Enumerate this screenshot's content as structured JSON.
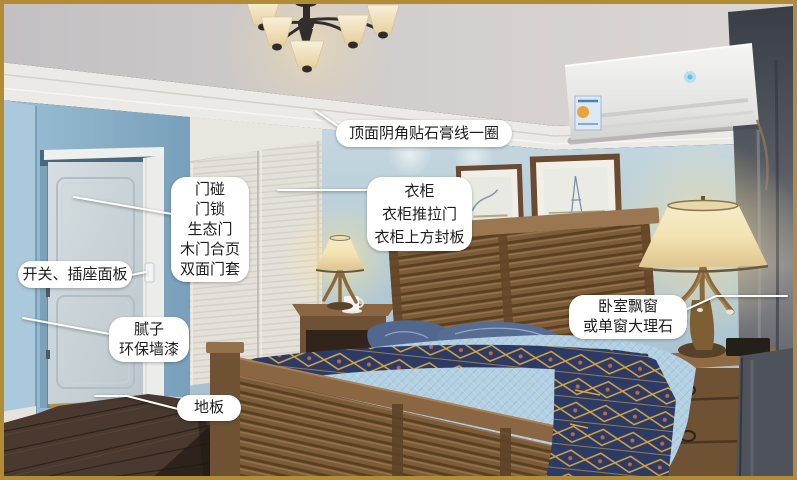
{
  "labels": {
    "ceiling": {
      "text": "顶面阴角贴石膏线一圈"
    },
    "door": {
      "lines": [
        "门碰",
        "门锁",
        "生态门",
        "木门合页",
        "双面门套"
      ]
    },
    "switch": {
      "text": "开关、插座面板"
    },
    "wall_paint": {
      "lines": [
        "腻子",
        "环保墙漆"
      ]
    },
    "floor": {
      "text": "地板"
    },
    "wardrobe": {
      "lines": [
        "衣柜",
        "衣柜推拉门",
        "衣柜上方封板"
      ]
    },
    "bay_window": {
      "lines": [
        "卧室飘窗",
        "或单窗大理石"
      ]
    }
  },
  "scene": {
    "objects": [
      "chandelier",
      "crown-molding",
      "air-conditioner",
      "wall-art",
      "wardrobe-sliding-doors",
      "eco-door",
      "light-switch",
      "bed",
      "headboard",
      "pillows",
      "throw-blanket",
      "footboard",
      "nightstands",
      "table-lamps",
      "curtain",
      "wood-floor"
    ],
    "colors": {
      "frame_gold": "#b28c34",
      "ceiling_gray": "#cfccce",
      "molding_white": "#eceae6",
      "wall_blue": "#85abc4",
      "back_wall_blue": "#b7cdd9",
      "wardrobe_white": "#e4e1db",
      "door_white": "#cbd4da",
      "headboard_wood": "#7c5b39",
      "nightstand_wood": "#6f5234",
      "floor_wood": "#4a392e",
      "bedspread_blue": "#b3d0e2",
      "pillow_blue": "#52678e",
      "throw_navy": "#2c3a66",
      "throw_gold": "#d9a63f",
      "throw_orange": "#c4683a",
      "lampshade_cream": "#f0e0b2",
      "curtain_gray": "#565b64",
      "ac_white": "#ebebe9",
      "callout_bg": "#ffffff",
      "callout_text": "#1d1d1d",
      "callout_line": "#ffffff"
    }
  }
}
